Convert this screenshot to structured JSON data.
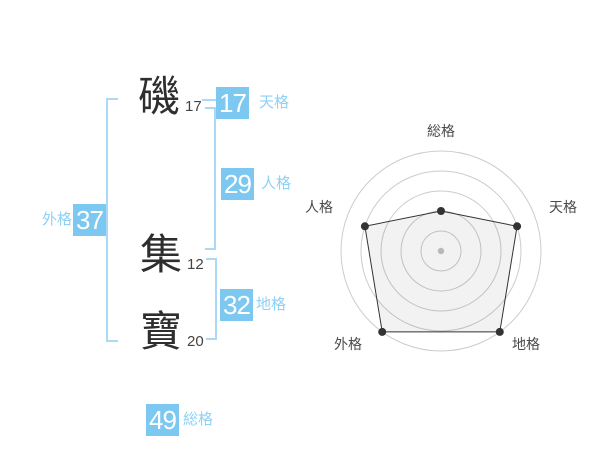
{
  "name_display": {
    "characters": [
      {
        "char": "磯",
        "strokes": "17"
      },
      {
        "char": "集",
        "strokes": "12"
      },
      {
        "char": "寶",
        "strokes": "20"
      }
    ]
  },
  "badges": {
    "tenkaku": {
      "value": "17",
      "label": "天格"
    },
    "jinkaku": {
      "value": "29",
      "label": "人格"
    },
    "chikaku": {
      "value": "32",
      "label": "地格"
    },
    "gaikaku": {
      "value": "37",
      "label": "外格"
    },
    "soukaku": {
      "value": "49",
      "label": "総格"
    }
  },
  "colors": {
    "badge_bg": "#7dc8f1",
    "badge_text": "#ffffff",
    "label_text": "#8ed1f6",
    "bracket": "#a9d9f6",
    "kanji": "#2e2e2e",
    "stroke_number": "#444444",
    "chart_grid": "#cccccc",
    "chart_line": "#333333",
    "chart_fill": "rgba(0,0,0,0.05)",
    "chart_label": "#4a4a4a",
    "chart_center_dot": "#c3c3c3"
  },
  "chart_data": {
    "type": "radar",
    "title": "",
    "categories": [
      "総格",
      "天格",
      "地格",
      "外格",
      "人格"
    ],
    "values": [
      2,
      4,
      5,
      5,
      4
    ],
    "max": 5,
    "rings": 5,
    "grid": "concentric-circles",
    "legend": "none"
  }
}
